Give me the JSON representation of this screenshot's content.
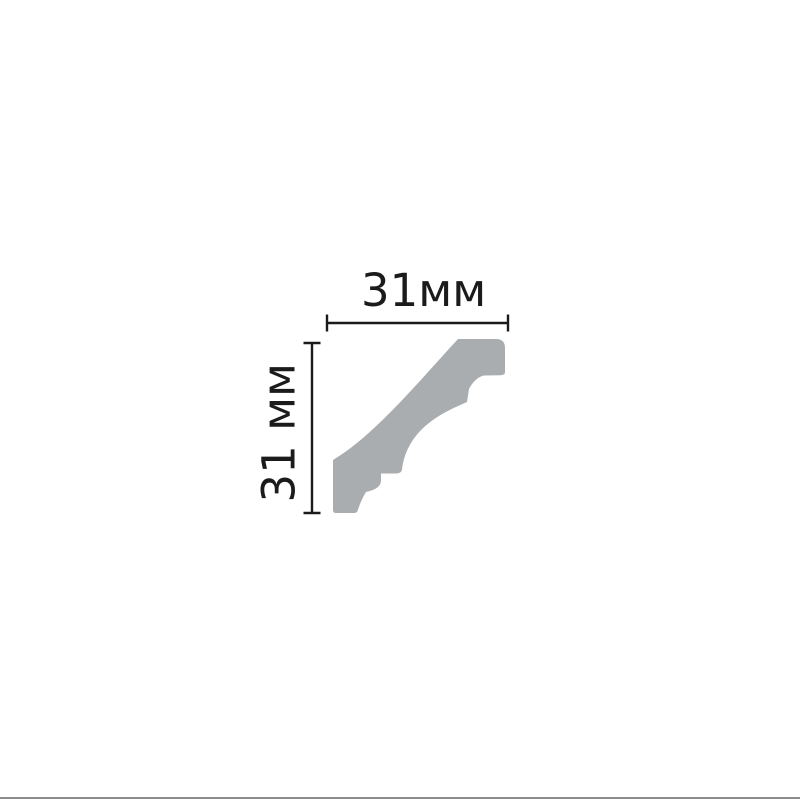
{
  "diagram": {
    "subject": "crown-molding-profile-cross-section",
    "width_label": "31мм",
    "height_label": "31 мм",
    "width_value_mm": 31,
    "height_value_mm": 31,
    "colors": {
      "background": "#ffffff",
      "molding_fill": "#aaadaf",
      "dimension_line": "#1b1b1b",
      "label_text": "#1b1b1b",
      "bottom_border": "#8d8d8d"
    }
  }
}
